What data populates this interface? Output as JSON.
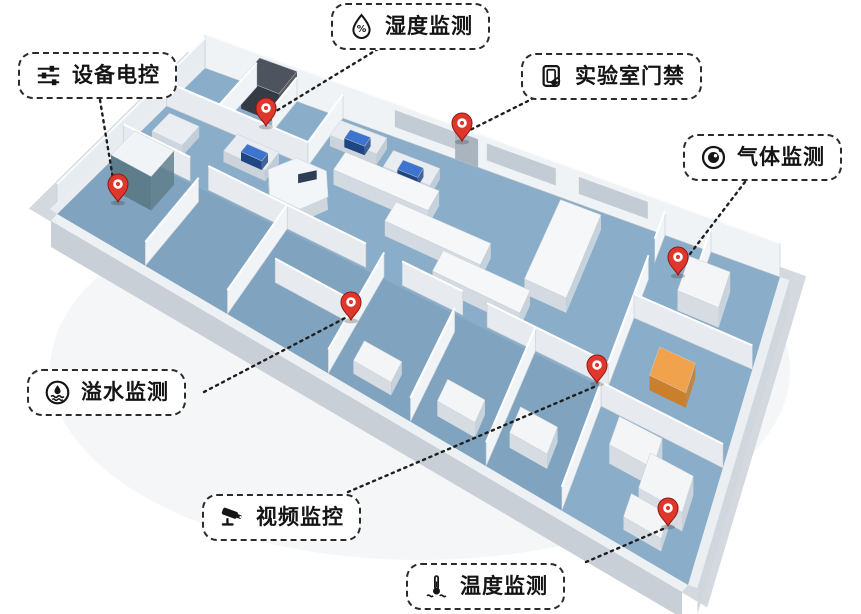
{
  "colors": {
    "floor_blue": "#8aadc9",
    "wall_white": "#f0f3f6",
    "exterior_gray": "#c8cfd7",
    "pin_red": "#df372c",
    "callout_border": "#2b2b2b",
    "equipment_orange": "#f0a24d",
    "monitor_blue": "#3d74cf",
    "text": "#141414"
  },
  "labels": [
    {
      "id": "equipment-control",
      "text": "设备电控",
      "icon": "sliders-icon"
    },
    {
      "id": "humidity",
      "text": "湿度监测",
      "icon": "humidity-drop-icon"
    },
    {
      "id": "lab-access",
      "text": "实验室门禁",
      "icon": "door-access-icon"
    },
    {
      "id": "gas",
      "text": "气体监测",
      "icon": "gas-sensor-icon"
    },
    {
      "id": "water-overflow",
      "text": "溢水监测",
      "icon": "water-overflow-icon"
    },
    {
      "id": "video",
      "text": "视频监控",
      "icon": "cctv-camera-icon"
    },
    {
      "id": "temperature",
      "text": "温度监测",
      "icon": "thermometer-icon"
    }
  ]
}
